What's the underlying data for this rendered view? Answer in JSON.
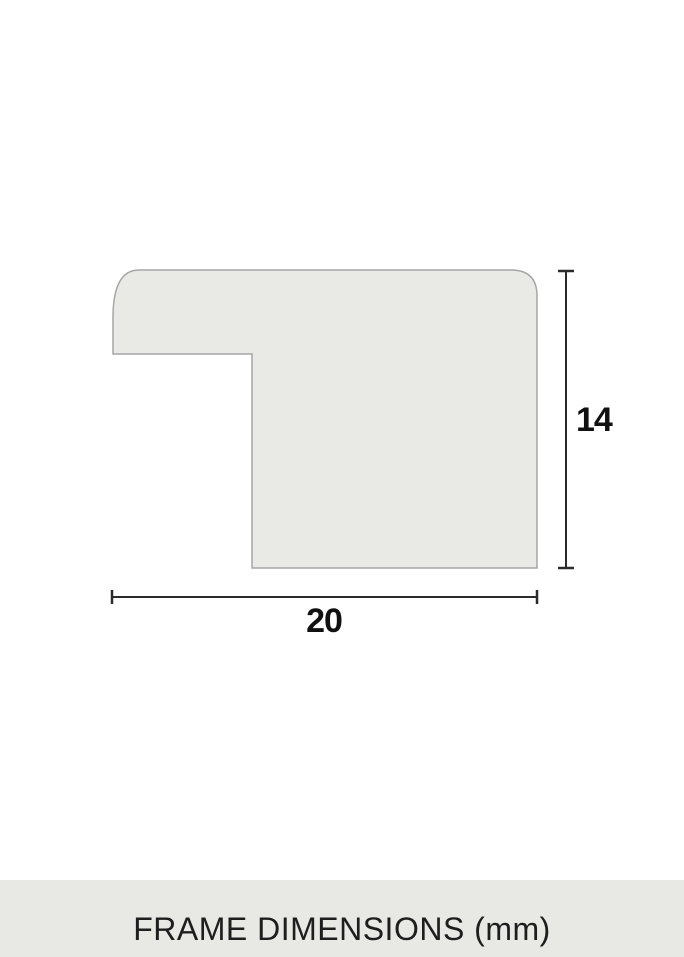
{
  "diagram": {
    "type": "frame-moulding-profile-cross-section",
    "height_label": "14",
    "width_label": "20",
    "units": "mm"
  },
  "footer": {
    "caption": "FRAME DIMENSIONS (mm)"
  },
  "colors": {
    "page_bg": "#ffffff",
    "shape_fill": "#e9e9e6",
    "shape_border": "#a6a6a6",
    "dimension_line": "#2b2b2b",
    "label_text": "#111111",
    "footer_bg": "#e8e8e4",
    "footer_text": "#1e1e1e"
  }
}
